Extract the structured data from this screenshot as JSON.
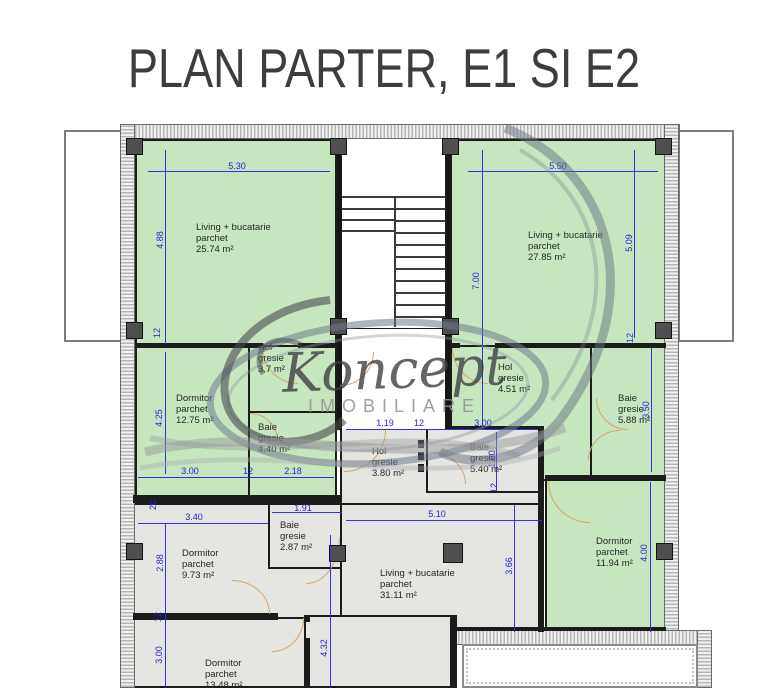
{
  "title": "PLAN PARTER, E1 SI E2",
  "watermark": {
    "brand": "Koncept",
    "subtitle": "IMOBILIARE"
  },
  "colors": {
    "room_green": "#c7e6c0",
    "room_gray": "#e4e4e1",
    "dimension_blue": "#2424d8",
    "wall_black": "#1c1c1c",
    "door_tan": "#dca25e"
  },
  "rooms": {
    "living_e1": {
      "l1": "Living + bucatarie",
      "l2": "parchet",
      "l3": "25.74 m²"
    },
    "dormitor_e1": {
      "l1": "Dormitor",
      "l2": "parchet",
      "l3": "12.75 m²"
    },
    "hol_e1": {
      "l1": "Hol",
      "l2": "gresie",
      "l3": "3.7 m²"
    },
    "baie_e1": {
      "l1": "Baie",
      "l2": "gresie",
      "l3": "4.40 m²"
    },
    "living_e2": {
      "l1": "Living + bucatarie",
      "l2": "parchet",
      "l3": "27.85 m²"
    },
    "hol_e2": {
      "l1": "Hol",
      "l2": "gresie",
      "l3": "4.51 m²"
    },
    "baie_e2": {
      "l1": "Baie",
      "l2": "gresie",
      "l3": "5.88 m²"
    },
    "dormitor_e2": {
      "l1": "Dormitor",
      "l2": "parchet",
      "l3": "11.94 m²"
    },
    "hol_parter": {
      "l1": "Hol",
      "l2": "gresie",
      "l3": "3.80 m²"
    },
    "baie_parter": {
      "l1": "Baie",
      "l2": "gresie",
      "l3": "5.40 m²"
    },
    "dormitor2_parter": {
      "l1": "Dormitor",
      "l2": "parchet",
      "l3": "9.73 m²"
    },
    "baie2_parter": {
      "l1": "Baie",
      "l2": "gresie",
      "l3": "2.87 m²"
    },
    "dormitor3_parter": {
      "l1": "Dormitor",
      "l2": "parchet",
      "l3": "13.48 m²"
    },
    "living_parter": {
      "l1": "Living + bucatarie",
      "l2": "parchet",
      "l3": "31.11 m²"
    }
  },
  "dimensions": {
    "e1_living_w": "5.30",
    "e1_living_h": "4.88",
    "wall12_a": "12",
    "e1_dorm_h": "4.25",
    "e1_dorm_w": "3.00",
    "wall12_b": "12",
    "e1_baie_w": "2.18",
    "wall20": "20",
    "p_dorm2_w": "3.40",
    "p_dorm2_h": "2.88",
    "wall12_c": "12",
    "p_dorm3_h": "3.00",
    "p_baie2_w": "1.91",
    "p_wall_h": "4.32",
    "p_hol_w": "1.19",
    "wall12_d": "12",
    "p_baie_w": "3.00",
    "p_baie_h": "1.80",
    "wall12_e": "12",
    "p_living_w": "5.10",
    "p_living_h": "3.66",
    "e2_living_w": "5.50",
    "e2_living_h": "7.00",
    "e2_living_h2": "5.09",
    "wall12_f": "12",
    "e2_baie_h": "3.50",
    "e2_dorm_h": "4.00"
  }
}
